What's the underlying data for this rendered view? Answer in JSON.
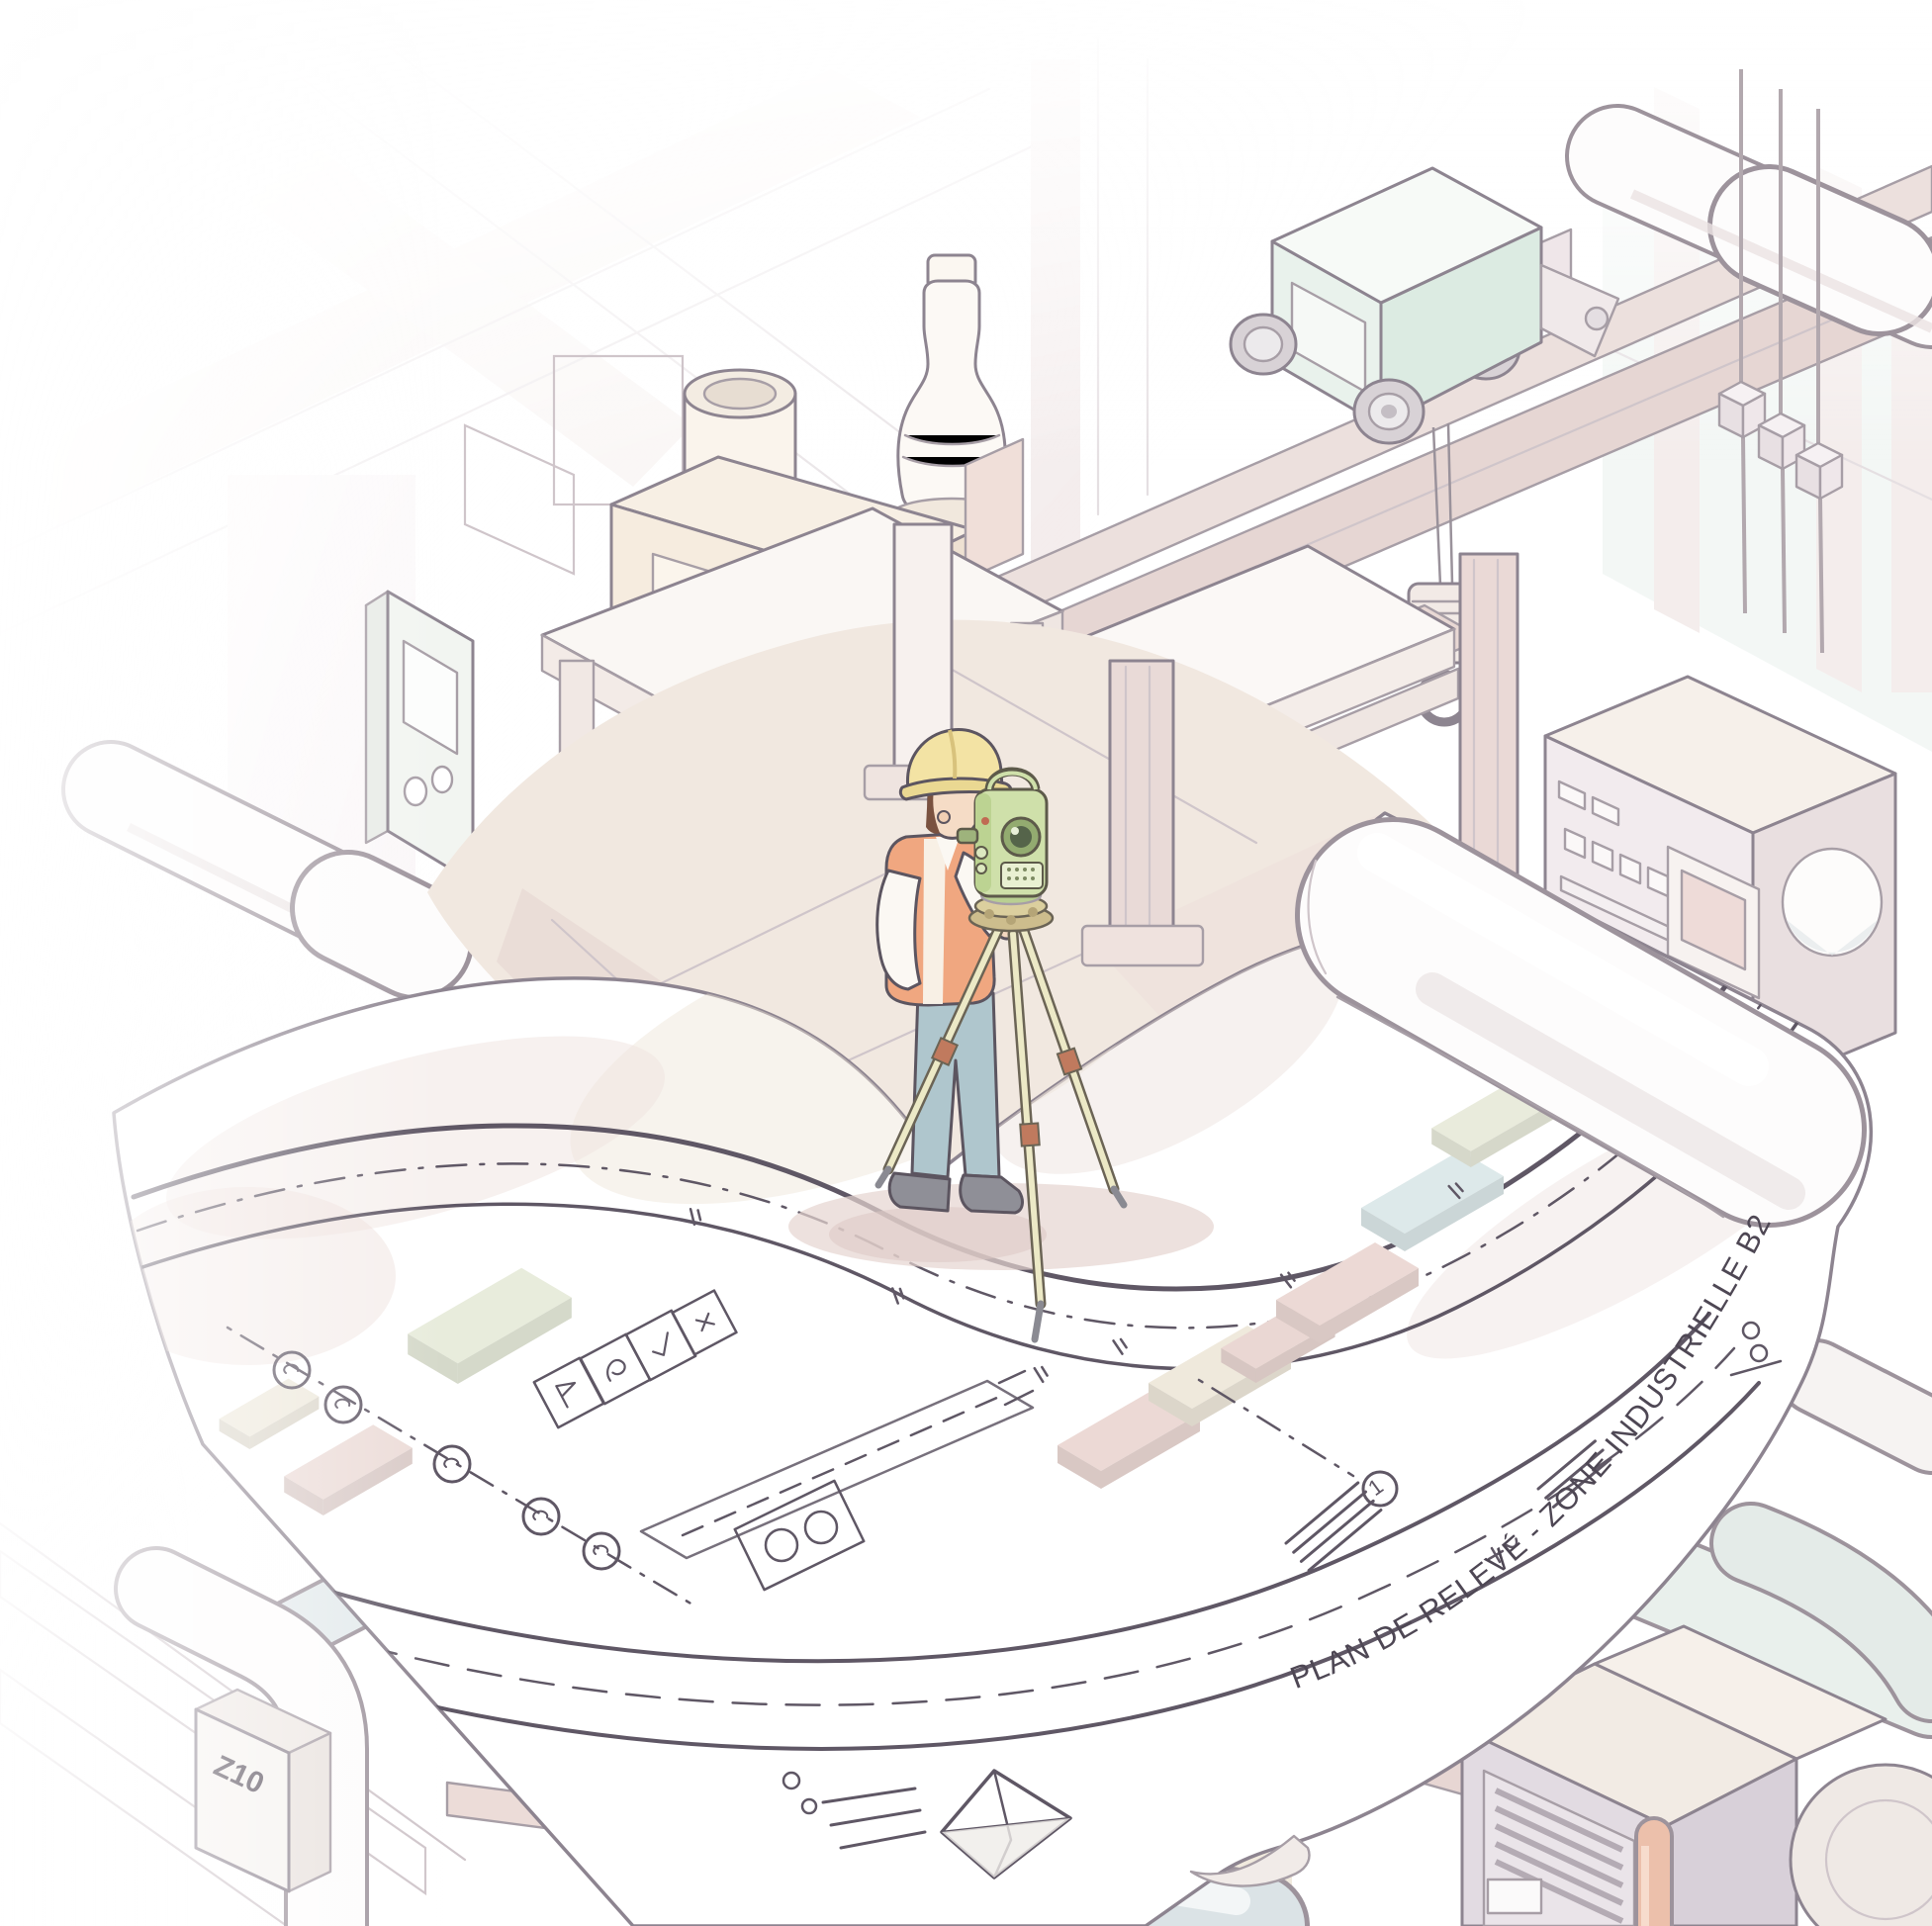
{
  "scene": "Isometric illustration of a surveyor with a total station on a large rolled blueprint inside an industrial plant",
  "blueprint": {
    "title": "PLAN DE RELEVÉ - ZONE INDUSTRIELLE B2",
    "marker_label": "1",
    "equipment_tag": "Z10"
  },
  "palette": {
    "paper": "#ffffff",
    "plan_line": "#5f5765",
    "outline": "#8d8490",
    "floor": "#f1e8e0",
    "floor_shadow": "#e7d6d2",
    "beam_pink": "#e9dad7",
    "trolley_mint": "#e5efe9",
    "teal_glass": "#e2ece8",
    "helmet_yellow": "#f3e3a4",
    "vest_orange": "#f0a780",
    "pants_blue": "#afc6cd",
    "instrument_green": "#cfe0aa",
    "tripod_tan": "#ece9c6",
    "accent_salmon": "#ecc0ab",
    "pipe_bluegray": "#dbe3e6"
  }
}
